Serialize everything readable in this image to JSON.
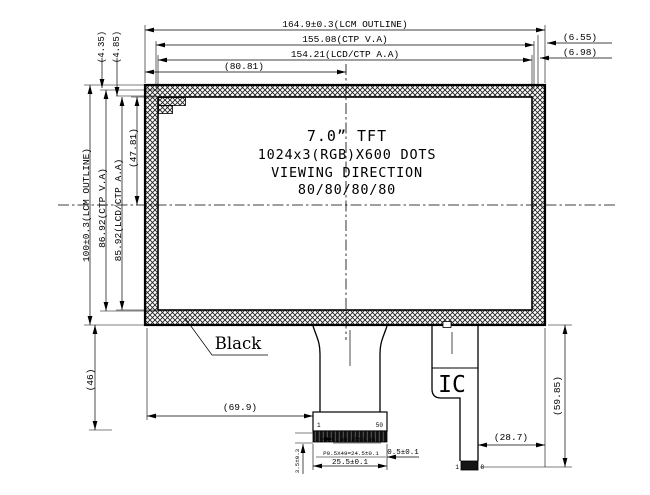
{
  "display_area": {
    "size": "7.0” TFT",
    "resolution": "1024x3(RGB)X600 DOTS",
    "viewing_label": "VIEWING DIRECTION",
    "viewing_angles": "80/80/80/80"
  },
  "labels": {
    "black": "Black",
    "ic": "IC",
    "pin_first": "1",
    "pin_last": "50",
    "ic_pin_first": "1",
    "ic_pin_last": "8"
  },
  "dims": {
    "lcm_width": "164.9±0.3(LCM OUTLINE)",
    "ctp_va_width": "155.08(CTP V.A)",
    "lcd_aa_width": "154.21(LCD/CTP A.A)",
    "center_offset_w": "(80.81)",
    "right_gap_1": "(6.55)",
    "right_gap_2": "(6.98)",
    "top_gap_1": "(4.35)",
    "top_gap_2": "(4.85)",
    "lcm_height": "100±0.3(LCM OUTLINE)",
    "ctp_va_height": "86.92(CTP V.A)",
    "lcd_aa_height": "85.92(LCD/CTP A.A)",
    "center_offset_h": "(47.81)",
    "bottom_zone_height": "(46)",
    "fpc_offset_x": "(69.9)",
    "pad_width": "W0.35±0.05",
    "pad_pitch": "P0.5X49=24.5±0.1",
    "connector_width": "25.5±0.1",
    "edge_clearance": "0.5±0.1",
    "stiffener_height": "3.5±0.3",
    "ic_tail_offset": "(28.7)",
    "fpc_length": "(59.85)"
  },
  "colors": {
    "line": "#000000",
    "background": "#ffffff",
    "contact_band": "#111111"
  }
}
